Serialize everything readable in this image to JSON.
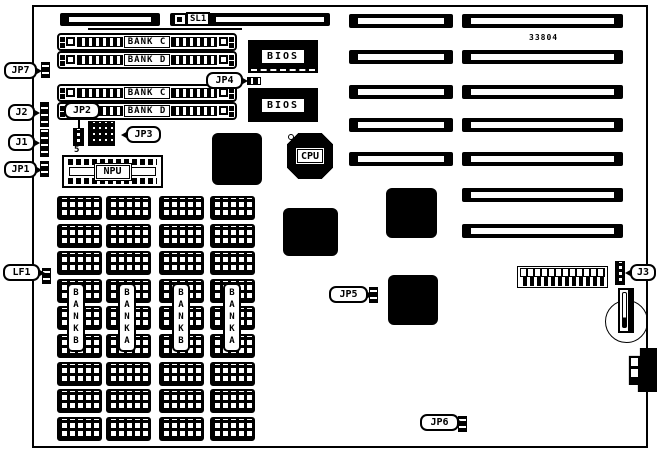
{
  "board": {
    "part_number": "33804"
  },
  "slots": {
    "sl1_label": "SL1",
    "left_column_count": 5,
    "right_column_count": 7
  },
  "simm_sockets": [
    {
      "label": "BANK C"
    },
    {
      "label": "BANK D"
    },
    {
      "label": "BANK C"
    },
    {
      "label": "BANK D"
    }
  ],
  "dram": {
    "rows": 9,
    "bank_labels": [
      "BANKB",
      "BANKA",
      "BANKB",
      "BANKA"
    ]
  },
  "chips": {
    "bios_top": "BIOS",
    "bios_bottom": "BIOS",
    "cpu": "CPU",
    "npu": "NPU"
  },
  "callouts": {
    "jp7": "JP7",
    "j2": "J2",
    "j1": "J1",
    "jp1": "JP1",
    "jp2": "JP2",
    "jp2_pin": "5",
    "jp3": "JP3",
    "jp4": "JP4",
    "jp5": "JP5",
    "jp6": "JP6",
    "lf1": "LF1",
    "j3": "J3"
  },
  "dip_switch": {
    "positions": 12
  }
}
